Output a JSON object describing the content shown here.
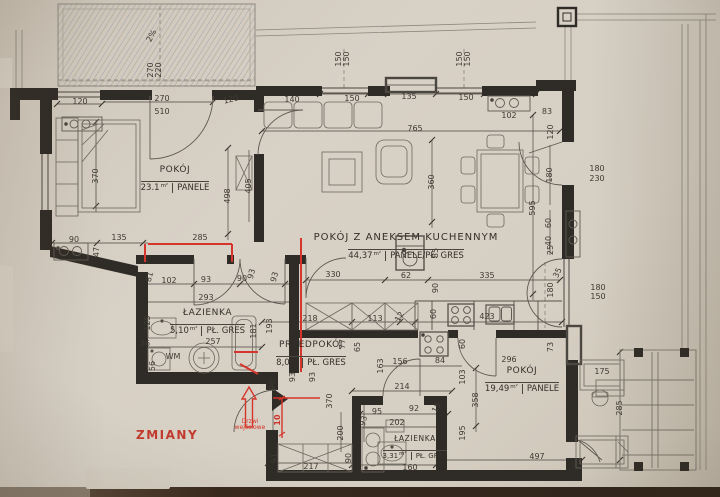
{
  "annotations": {
    "changes_label": "ZMIANY",
    "entrance_door_label": "Drzwi wejściowe",
    "terrace_slope": "2%",
    "washing_machine": "WM"
  },
  "colors": {
    "paper": "#d6cfc4",
    "ink": "#3e3a33",
    "walls": "#2f2b26",
    "change_red": "#d6352b"
  },
  "rooms": [
    {
      "name": "POKÓJ",
      "area": "23.1",
      "unit": "m²",
      "floor": "PANELE"
    },
    {
      "name": "POKÓJ Z ANEKSEM KUCHENNYM",
      "area": "44,37",
      "unit": "m²",
      "floor": "PANELE/PŁ. GRES"
    },
    {
      "name": "ŁAZIENKA",
      "area": "5,10",
      "unit": "m²",
      "floor": "PŁ. GRES"
    },
    {
      "name": "PRZEDPOKÓJ",
      "area": "8,0",
      "unit": "m²",
      "floor": "PŁ. GRES"
    },
    {
      "name": "POKÓJ",
      "area": "19,49",
      "unit": "m²",
      "floor": "PANELE"
    },
    {
      "name": "ŁAZIENKA",
      "area": "3,31",
      "unit": "m²",
      "floor": "PŁ. GRES"
    }
  ],
  "dimensions": [
    [
      "2%",
      152,
      36,
      -62
    ],
    [
      "270",
      151,
      70,
      -90
    ],
    [
      "220",
      159,
      70,
      -90
    ],
    [
      "120",
      80,
      102,
      0
    ],
    [
      "270",
      162,
      99,
      0
    ],
    [
      "510",
      162,
      112,
      0
    ],
    [
      "120",
      231,
      100,
      -14
    ],
    [
      "140",
      292,
      100,
      0
    ],
    [
      "150",
      339,
      59,
      -90
    ],
    [
      "150",
      347,
      59,
      -90
    ],
    [
      "150",
      352,
      99,
      0
    ],
    [
      "135",
      409,
      97,
      0
    ],
    [
      "150",
      460,
      59,
      -90
    ],
    [
      "150",
      468,
      59,
      -90
    ],
    [
      "150",
      466,
      98,
      0
    ],
    [
      "765",
      415,
      129,
      0
    ],
    [
      "102",
      509,
      116,
      0
    ],
    [
      "83",
      547,
      112,
      0
    ],
    [
      "120",
      551,
      132,
      -90
    ],
    [
      "370",
      96,
      176,
      -90
    ],
    [
      "498",
      228,
      196,
      -90
    ],
    [
      "405",
      249,
      186,
      -90
    ],
    [
      "90",
      74,
      240,
      0
    ],
    [
      "135",
      119,
      238,
      0
    ],
    [
      "285",
      200,
      238,
      0
    ],
    [
      "47",
      97,
      252,
      -90
    ],
    [
      "360",
      432,
      182,
      -90
    ],
    [
      "595",
      533,
      208,
      -90
    ],
    [
      "180",
      550,
      175,
      -90
    ],
    [
      "180",
      597,
      169,
      0
    ],
    [
      "230",
      597,
      179,
      0
    ],
    [
      "60",
      549,
      223,
      -90
    ],
    [
      "40",
      549,
      241,
      -90
    ],
    [
      "25",
      551,
      250,
      -90
    ],
    [
      "35",
      558,
      273,
      -65
    ],
    [
      "180",
      551,
      290,
      -90
    ],
    [
      "180",
      598,
      288,
      0
    ],
    [
      "150",
      598,
      297,
      0
    ],
    [
      "73",
      551,
      347,
      -90
    ],
    [
      "175",
      602,
      372,
      0
    ],
    [
      "285",
      620,
      408,
      -90
    ],
    [
      "81",
      150,
      277,
      -75
    ],
    [
      "102",
      169,
      281,
      0
    ],
    [
      "93",
      206,
      280,
      0
    ],
    [
      "90",
      242,
      279,
      0
    ],
    [
      "93",
      252,
      274,
      -75
    ],
    [
      "93",
      275,
      277,
      -75
    ],
    [
      "293",
      206,
      298,
      0
    ],
    [
      "257",
      213,
      342,
      0
    ],
    [
      "125",
      148,
      323,
      -90
    ],
    [
      "36",
      145,
      344,
      0
    ],
    [
      "56",
      153,
      366,
      -90
    ],
    [
      "WM",
      173,
      357,
      0
    ],
    [
      "181",
      254,
      331,
      -90
    ],
    [
      "193",
      270,
      326,
      -90
    ],
    [
      "330",
      333,
      275,
      0
    ],
    [
      "62",
      406,
      276,
      0
    ],
    [
      "335",
      487,
      276,
      0
    ],
    [
      "85",
      436,
      253,
      -90
    ],
    [
      "90",
      436,
      288,
      -90
    ],
    [
      "218",
      310,
      319,
      0
    ],
    [
      "113",
      375,
      319,
      0
    ],
    [
      "12",
      400,
      317,
      -60
    ],
    [
      "77",
      343,
      344,
      -90
    ],
    [
      "65",
      358,
      347,
      -90
    ],
    [
      "163",
      381,
      366,
      -90
    ],
    [
      "156",
      400,
      362,
      0
    ],
    [
      "84",
      440,
      361,
      0
    ],
    [
      "60",
      434,
      314,
      -90
    ],
    [
      "60",
      463,
      344,
      -90
    ],
    [
      "423",
      487,
      317,
      0
    ],
    [
      "103",
      463,
      377,
      -90
    ],
    [
      "93",
      293,
      377,
      -90
    ],
    [
      "93",
      313,
      377,
      -90
    ],
    [
      "214",
      402,
      387,
      0
    ],
    [
      "90",
      273,
      385,
      -90
    ],
    [
      "370",
      330,
      401,
      -90
    ],
    [
      "296",
      509,
      360,
      0
    ],
    [
      "358",
      476,
      400,
      -90
    ],
    [
      "195",
      463,
      433,
      -90
    ],
    [
      "95",
      377,
      412,
      0
    ],
    [
      "92",
      414,
      409,
      0
    ],
    [
      "15",
      437,
      408,
      -60
    ],
    [
      "202",
      397,
      423,
      0
    ],
    [
      "93",
      364,
      421,
      -75
    ],
    [
      "200",
      341,
      433,
      -90
    ],
    [
      "90",
      349,
      458,
      -90
    ],
    [
      "160",
      410,
      468,
      0
    ],
    [
      "91",
      275,
      458,
      -90
    ],
    [
      "217",
      311,
      467,
      0
    ],
    [
      "497",
      537,
      457,
      0
    ],
    [
      "10",
      278,
      420,
      -90,
      true
    ]
  ]
}
